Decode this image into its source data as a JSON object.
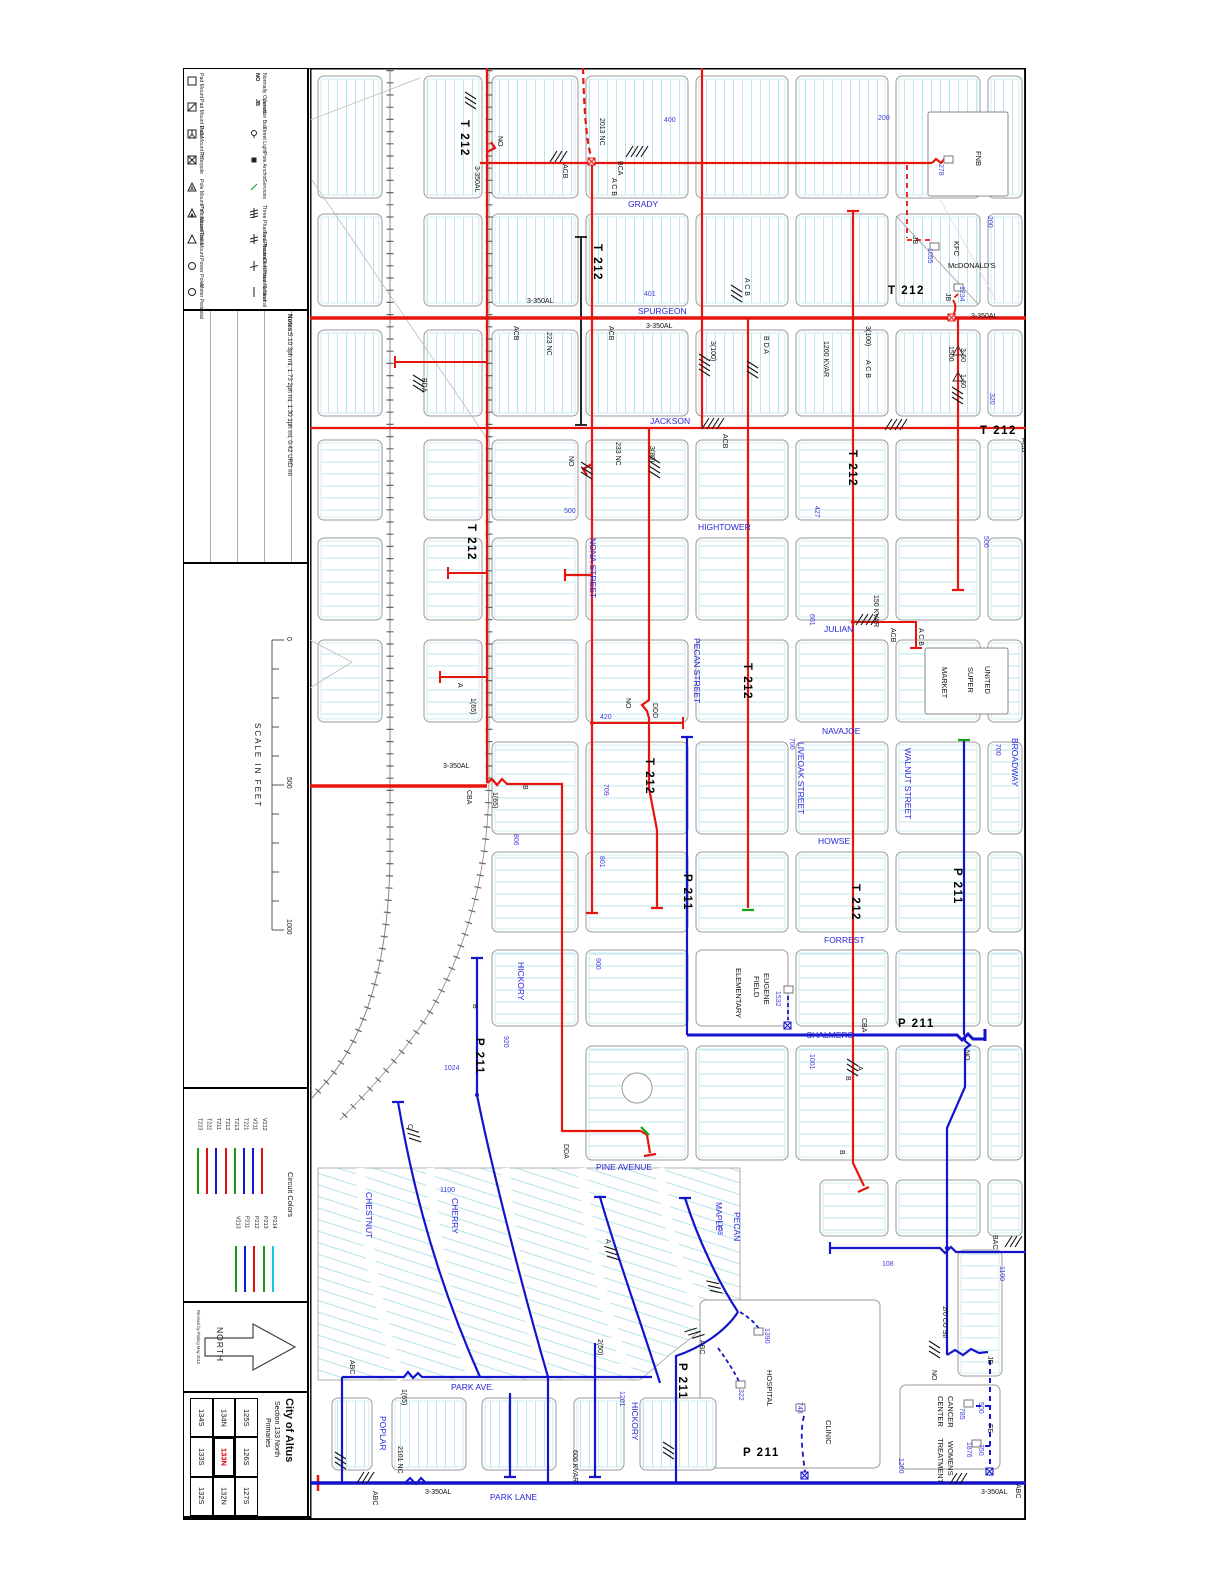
{
  "sheet": {
    "legend": {
      "col1": [
        {
          "s": "sq",
          "label": "Pad Mount"
        },
        {
          "s": "sqd",
          "label": "Pad Mount Delta"
        },
        {
          "s": "sqy",
          "label": "Pad Mount \"Y\""
        },
        {
          "s": "sqx",
          "label": "Riserpole"
        },
        {
          "s": "triy",
          "label": "Pole Mount \"Y\" station"
        },
        {
          "s": "trid",
          "label": "Pole Mount Delta"
        },
        {
          "s": "tri",
          "label": "Pole Mount"
        },
        {
          "s": "cir",
          "label": "Power Poles"
        },
        {
          "s": "cir",
          "label": "Meter Pedestal"
        }
      ],
      "col2": [
        {
          "s": "NO",
          "label": "Normally Opened"
        },
        {
          "s": "JB",
          "label": "Junction Box"
        },
        {
          "s": "sl",
          "label": "Street Light"
        },
        {
          "s": "pa",
          "label": "Pole Anchor"
        },
        {
          "s": "sv",
          "label": "Services"
        },
        {
          "s": "h3",
          "label": "Three Phases & Neutral"
        },
        {
          "s": "h2",
          "label": "Two Phases & Neutral"
        },
        {
          "s": "h1",
          "label": "One Phase & Neutral"
        },
        {
          "s": "nl",
          "label": "Neutral"
        }
      ]
    },
    "notes": {
      "title": "Notes:",
      "text": "5.10 3ph mi, 1.73 2ph mi, 1.30 1ph mi, 0.42 URD mi"
    },
    "scale": {
      "title": "SCALE IN FEET",
      "ticks": [
        "0",
        "500",
        "1000"
      ]
    },
    "circuit_colors": {
      "title": "Circuit Colors",
      "group1": [
        {
          "id": "T223",
          "color": "#1a9a1a"
        },
        {
          "id": "T222",
          "color": "#e01010"
        },
        {
          "id": "T211",
          "color": "#1515cc"
        },
        {
          "id": "T212",
          "color": "#e01010"
        },
        {
          "id": "T213",
          "color": "#1a9a1a"
        },
        {
          "id": "T221",
          "color": "#1515cc"
        },
        {
          "id": "V211",
          "color": "#1515cc"
        },
        {
          "id": "V212",
          "color": "#e01010"
        }
      ],
      "group2": [
        {
          "id": "V213",
          "color": "#1a9a1a"
        },
        {
          "id": "P211",
          "color": "#1515cc"
        },
        {
          "id": "P212",
          "color": "#e01010"
        },
        {
          "id": "P213",
          "color": "#1a9a1a"
        },
        {
          "id": "P214",
          "color": "#10c8e0"
        }
      ]
    },
    "north": {
      "label": "NORTH",
      "revised": "Revised by Plating May 2015"
    },
    "title_block": {
      "city": "City of Altus",
      "section": "Section 133 North",
      "type": "Primaries",
      "grid": [
        [
          "125S",
          "126S",
          "127S"
        ],
        [
          "134N",
          "133N",
          "132N"
        ],
        [
          "134S",
          "133S",
          "132S"
        ]
      ],
      "highlight": "133N"
    }
  },
  "map": {
    "labels": [
      [
        "GRADY",
        628,
        207,
        "h",
        "s"
      ],
      [
        "SPURGEON",
        638,
        314,
        "h",
        "s"
      ],
      [
        "JACKSON",
        650,
        424,
        "h",
        "s"
      ],
      [
        "HIGHTOWER",
        698,
        530,
        "h",
        "s"
      ],
      [
        "JULIAN",
        824,
        632,
        "h",
        "s"
      ],
      [
        "NAVAJOE",
        822,
        734,
        "h",
        "s"
      ],
      [
        "HOWSE",
        818,
        844,
        "h",
        "s"
      ],
      [
        "FORREST",
        824,
        943,
        "h",
        "s"
      ],
      [
        "CHALMERS",
        806,
        1038,
        "h",
        "s"
      ],
      [
        "PINE AVENUE",
        596,
        1170,
        "h",
        "s"
      ],
      [
        "PARK AVE.",
        451,
        1390,
        "h",
        "s"
      ],
      [
        "PARK LANE",
        490,
        1500,
        "h",
        "s"
      ],
      [
        "NONA STREET",
        590,
        538,
        "v",
        "s"
      ],
      [
        "PECAN STREET",
        694,
        638,
        "v",
        "s"
      ],
      [
        "LIVEOAK STREET",
        798,
        742,
        "v",
        "s"
      ],
      [
        "WALNUT STREET",
        905,
        748,
        "v",
        "s"
      ],
      [
        "BROADWAY",
        1012,
        738,
        "v",
        "s"
      ],
      [
        "HICKORY",
        518,
        962,
        "v",
        "s"
      ],
      [
        "CHESTNUT",
        366,
        1192,
        "v",
        "s"
      ],
      [
        "CHERRY",
        452,
        1198,
        "v",
        "s"
      ],
      [
        "MAPLE",
        716,
        1202,
        "v",
        "s"
      ],
      [
        "PECAN",
        734,
        1212,
        "v",
        "s"
      ],
      [
        "POPLAR",
        380,
        1416,
        "v",
        "s"
      ],
      [
        "HICKORY",
        632,
        1402,
        "v",
        "s"
      ],
      [
        "400",
        664,
        122,
        "h",
        "n"
      ],
      [
        "200",
        878,
        120,
        "h",
        "n"
      ],
      [
        "200",
        988,
        216,
        "v",
        "n"
      ],
      [
        "401",
        644,
        296,
        "h",
        "n"
      ],
      [
        "320",
        990,
        393,
        "v",
        "n"
      ],
      [
        "500",
        564,
        513,
        "h",
        "n"
      ],
      [
        "427",
        815,
        506,
        "v",
        "n"
      ],
      [
        "500",
        984,
        536,
        "v",
        "n"
      ],
      [
        "601",
        810,
        614,
        "v",
        "n"
      ],
      [
        "700",
        996,
        744,
        "v",
        "n"
      ],
      [
        "700",
        790,
        738,
        "v",
        "n"
      ],
      [
        "709",
        604,
        784,
        "v",
        "n"
      ],
      [
        "801",
        600,
        856,
        "v",
        "n"
      ],
      [
        "806",
        514,
        834,
        "v",
        "n"
      ],
      [
        "900",
        596,
        958,
        "v",
        "n"
      ],
      [
        "920",
        504,
        1036,
        "v",
        "n"
      ],
      [
        "1001",
        810,
        1054,
        "v",
        "n"
      ],
      [
        "1024",
        444,
        1070,
        "h",
        "n"
      ],
      [
        "1100",
        440,
        1192,
        "h",
        "n"
      ],
      [
        "1108",
        718,
        1220,
        "v",
        "n"
      ],
      [
        "1201",
        620,
        1391,
        "v",
        "n"
      ],
      [
        "1200",
        899,
        1458,
        "v",
        "n"
      ],
      [
        "1100",
        1000,
        1266,
        "v",
        "n"
      ],
      [
        "108",
        882,
        1266,
        "h",
        "n"
      ],
      [
        "278",
        939,
        164,
        "v",
        "n"
      ],
      [
        "1055",
        928,
        248,
        "v",
        "n"
      ],
      [
        "1234",
        960,
        286,
        "v",
        "n"
      ],
      [
        "1532",
        776,
        991,
        "v",
        "n"
      ],
      [
        "1390",
        765,
        1328,
        "v",
        "n"
      ],
      [
        "322",
        739,
        1389,
        "v",
        "n"
      ],
      [
        "743",
        798,
        1402,
        "v",
        "n"
      ],
      [
        "785",
        960,
        1408,
        "v",
        "n"
      ],
      [
        "500",
        979,
        1402,
        "v",
        "n"
      ],
      [
        "1876",
        967,
        1442,
        "v",
        "n"
      ],
      [
        "750",
        979,
        1444,
        "v",
        "n"
      ],
      [
        "420",
        600,
        719,
        "h",
        "n"
      ],
      [
        "T 212",
        461,
        120,
        "v",
        "c"
      ],
      [
        "T 212",
        594,
        244,
        "v",
        "c"
      ],
      [
        "T 212",
        888,
        294,
        "h",
        "c"
      ],
      [
        "T 212",
        980,
        434,
        "h",
        "c"
      ],
      [
        "T 212",
        849,
        450,
        "v",
        "c"
      ],
      [
        "T 212",
        744,
        663,
        "v",
        "c"
      ],
      [
        "T 212",
        646,
        758,
        "v",
        "c"
      ],
      [
        "T 212",
        852,
        884,
        "v",
        "c"
      ],
      [
        "T 212",
        468,
        524,
        "v",
        "c"
      ],
      [
        "P 211",
        684,
        874,
        "v",
        "c"
      ],
      [
        "P 211",
        954,
        868,
        "v",
        "c"
      ],
      [
        "P 211",
        476,
        1038,
        "v",
        "c"
      ],
      [
        "P 211",
        898,
        1027,
        "h",
        "c"
      ],
      [
        "P 211",
        679,
        1363,
        "v",
        "c"
      ],
      [
        "P 211",
        743,
        1456,
        "h",
        "c"
      ],
      [
        "NO",
        498,
        136,
        "v",
        "a"
      ],
      [
        "2013 NC",
        600,
        118,
        "v",
        "a"
      ],
      [
        "223 NC",
        547,
        332,
        "v",
        "a"
      ],
      [
        "233 NC",
        616,
        442,
        "v",
        "a"
      ],
      [
        "2101 NC",
        398,
        1446,
        "v",
        "a"
      ],
      [
        "NO",
        569,
        456,
        "v",
        "a"
      ],
      [
        "NO",
        626,
        698,
        "v",
        "a"
      ],
      [
        "NO",
        965,
        1050,
        "v",
        "a"
      ],
      [
        "NO",
        932,
        1370,
        "v",
        "a"
      ],
      [
        "3-350AL",
        475,
        166,
        "v",
        "a"
      ],
      [
        "3-350AL",
        646,
        328,
        "h",
        "a"
      ],
      [
        "3-350AL",
        971,
        318,
        "h",
        "a"
      ],
      [
        "3-350AL",
        527,
        303,
        "h",
        "a"
      ],
      [
        "3-350AL",
        443,
        768,
        "h",
        "a"
      ],
      [
        "3-350AL",
        425,
        1494,
        "h",
        "a"
      ],
      [
        "3-350AL",
        981,
        1494,
        "h",
        "a"
      ],
      [
        "ACB",
        563,
        164,
        "v",
        "a"
      ],
      [
        "BCA",
        618,
        161,
        "v",
        "a"
      ],
      [
        "ACB",
        514,
        326,
        "v",
        "a"
      ],
      [
        "ACB",
        609,
        326,
        "v",
        "a"
      ],
      [
        "ACB",
        723,
        434,
        "v",
        "a"
      ],
      [
        "ACB",
        1022,
        438,
        "v",
        "a"
      ],
      [
        "ACB",
        891,
        628,
        "v",
        "a"
      ],
      [
        "BDA",
        422,
        378,
        "v",
        "a"
      ],
      [
        "B D A",
        764,
        336,
        "v",
        "a"
      ],
      [
        "A C B",
        866,
        360,
        "v",
        "a"
      ],
      [
        "A C B",
        919,
        628,
        "v",
        "a"
      ],
      [
        "A C B",
        745,
        278,
        "v",
        "a"
      ],
      [
        "A C B",
        612,
        178,
        "v",
        "a"
      ],
      [
        "CBA",
        862,
        1018,
        "v",
        "a"
      ],
      [
        "CBA",
        467,
        790,
        "v",
        "a"
      ],
      [
        "DDA",
        564,
        1144,
        "v",
        "a"
      ],
      [
        "DDD",
        653,
        703,
        "v",
        "a"
      ],
      [
        "ABC",
        350,
        1360,
        "v",
        "a"
      ],
      [
        "ABC",
        373,
        1491,
        "v",
        "a"
      ],
      [
        "ABC",
        1016,
        1484,
        "v",
        "a"
      ],
      [
        "BAC",
        993,
        1235,
        "v",
        "a"
      ],
      [
        "1200 KVAR",
        824,
        341,
        "v",
        "a"
      ],
      [
        "150 KVAR",
        874,
        595,
        "v",
        "a"
      ],
      [
        "600 KVAR",
        573,
        1450,
        "v",
        "a"
      ],
      [
        "3(100)",
        711,
        341,
        "v",
        "a"
      ],
      [
        "3(100)",
        866,
        326,
        "v",
        "a"
      ],
      [
        "3(80)",
        650,
        446,
        "v",
        "a"
      ],
      [
        "1(65)",
        471,
        698,
        "v",
        "a"
      ],
      [
        "1(65)",
        493,
        792,
        "v",
        "a"
      ],
      [
        "1(65)",
        402,
        1389,
        "v",
        "a"
      ],
      [
        "2(50)",
        598,
        1339,
        "v",
        "a"
      ],
      [
        "1500",
        949,
        346,
        "v",
        "a"
      ],
      [
        "3-50",
        961,
        348,
        "v",
        "a"
      ],
      [
        "1-50",
        961,
        374,
        "v",
        "a"
      ],
      [
        "2/0 CU Str",
        943,
        1306,
        "v",
        "a"
      ],
      [
        "JB",
        913,
        236,
        "v",
        "a"
      ],
      [
        "JB",
        946,
        293,
        "v",
        "a"
      ],
      [
        "JB",
        988,
        1356,
        "v",
        "a"
      ],
      [
        "FE",
        988,
        1424,
        "v",
        "a"
      ],
      [
        "A",
        458,
        683,
        "v",
        "a"
      ],
      [
        "B",
        523,
        785,
        "v",
        "a"
      ],
      [
        "B",
        473,
        1004,
        "v",
        "a"
      ],
      [
        "A",
        858,
        1066,
        "v",
        "a"
      ],
      [
        "B",
        846,
        1076,
        "v",
        "a"
      ],
      [
        "A",
        606,
        1239,
        "v",
        "a"
      ],
      [
        "C",
        408,
        1124,
        "v",
        "a"
      ],
      [
        "ABC",
        700,
        1340,
        "v",
        "a"
      ],
      [
        "B",
        840,
        1150,
        "v",
        "a"
      ],
      [
        "FNB",
        976,
        151,
        "v",
        "b"
      ],
      [
        "KFC",
        954,
        241,
        "v",
        "b"
      ],
      [
        "McDONALD'S",
        948,
        268,
        "h",
        "b"
      ],
      [
        "UNITED",
        985,
        666,
        "v",
        "b"
      ],
      [
        "SUPER",
        968,
        667,
        "v",
        "b"
      ],
      [
        "MARKET",
        942,
        667,
        "v",
        "b"
      ],
      [
        "EUGENE",
        764,
        973,
        "v",
        "b"
      ],
      [
        "FIELD",
        754,
        976,
        "v",
        "b"
      ],
      [
        "ELEMENTARY",
        736,
        968,
        "v",
        "b"
      ],
      [
        "HOSPITAL",
        767,
        1370,
        "v",
        "b"
      ],
      [
        "CLINIC",
        826,
        1420,
        "v",
        "b"
      ],
      [
        "CANCER",
        948,
        1396,
        "v",
        "b"
      ],
      [
        "CENTER",
        938,
        1396,
        "v",
        "b"
      ],
      [
        "WOMENS",
        948,
        1441,
        "v",
        "b"
      ],
      [
        "TREATMENT",
        938,
        1438,
        "v",
        "b"
      ]
    ]
  },
  "colors": {
    "red": "#e8150f",
    "blue": "#1414cc",
    "green": "#18a018",
    "parcel": "#a8dfe8",
    "cyan": "#10c8e0"
  }
}
